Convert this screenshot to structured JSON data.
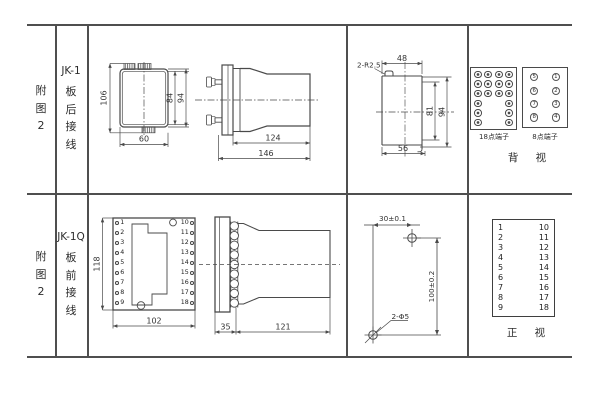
{
  "rows": [
    {
      "fig_label": "附\n图\n2",
      "model": "JK-1",
      "wiring": "板\n后\n接\n线"
    },
    {
      "fig_label": "附\n图\n2",
      "model": "JK-1Q",
      "wiring": "板\n前\n接\n线"
    }
  ],
  "jk1": {
    "front": {
      "height_overall": "106",
      "height_inner": "84",
      "height_outer": "94",
      "width": "60"
    },
    "side": {
      "body_length": "124",
      "overall_length": "146"
    },
    "cutout": {
      "corner_note": "2-R2.5",
      "top_width": "48",
      "inner_height": "81",
      "outer_height": "94",
      "bottom_width": "56"
    },
    "back_view": {
      "label": "背 视",
      "terminal18_label": "18点端子",
      "terminal8_label": "8点端子",
      "terminal18_pattern": [
        4,
        4,
        4,
        2,
        2,
        2
      ],
      "terminal8_rows": [
        [
          "5",
          "1"
        ],
        [
          "6",
          "2"
        ],
        [
          "7",
          "3"
        ],
        [
          "8",
          "4"
        ]
      ]
    }
  },
  "jk1q": {
    "front": {
      "height": "118",
      "width": "102",
      "left_terminals": [
        "1",
        "2",
        "3",
        "4",
        "5",
        "6",
        "7",
        "8",
        "9"
      ],
      "right_terminals": [
        "10",
        "11",
        "12",
        "13",
        "14",
        "15",
        "16",
        "17",
        "18"
      ]
    },
    "side": {
      "panel_depth": "35",
      "body_length": "121"
    },
    "drill": {
      "horizontal": "30±0.1",
      "vertical": "100±0.2",
      "holes": "2-Φ5"
    },
    "front_view": {
      "label": "正 视",
      "left": [
        "1",
        "2",
        "3",
        "4",
        "5",
        "6",
        "7",
        "8",
        "9"
      ],
      "right": [
        "10",
        "11",
        "12",
        "13",
        "14",
        "15",
        "16",
        "17",
        "18"
      ]
    }
  },
  "colors": {
    "line": "#4a4a4a",
    "table_line": "#4f4f4f",
    "text": "#333333",
    "background": "#ffffff"
  }
}
